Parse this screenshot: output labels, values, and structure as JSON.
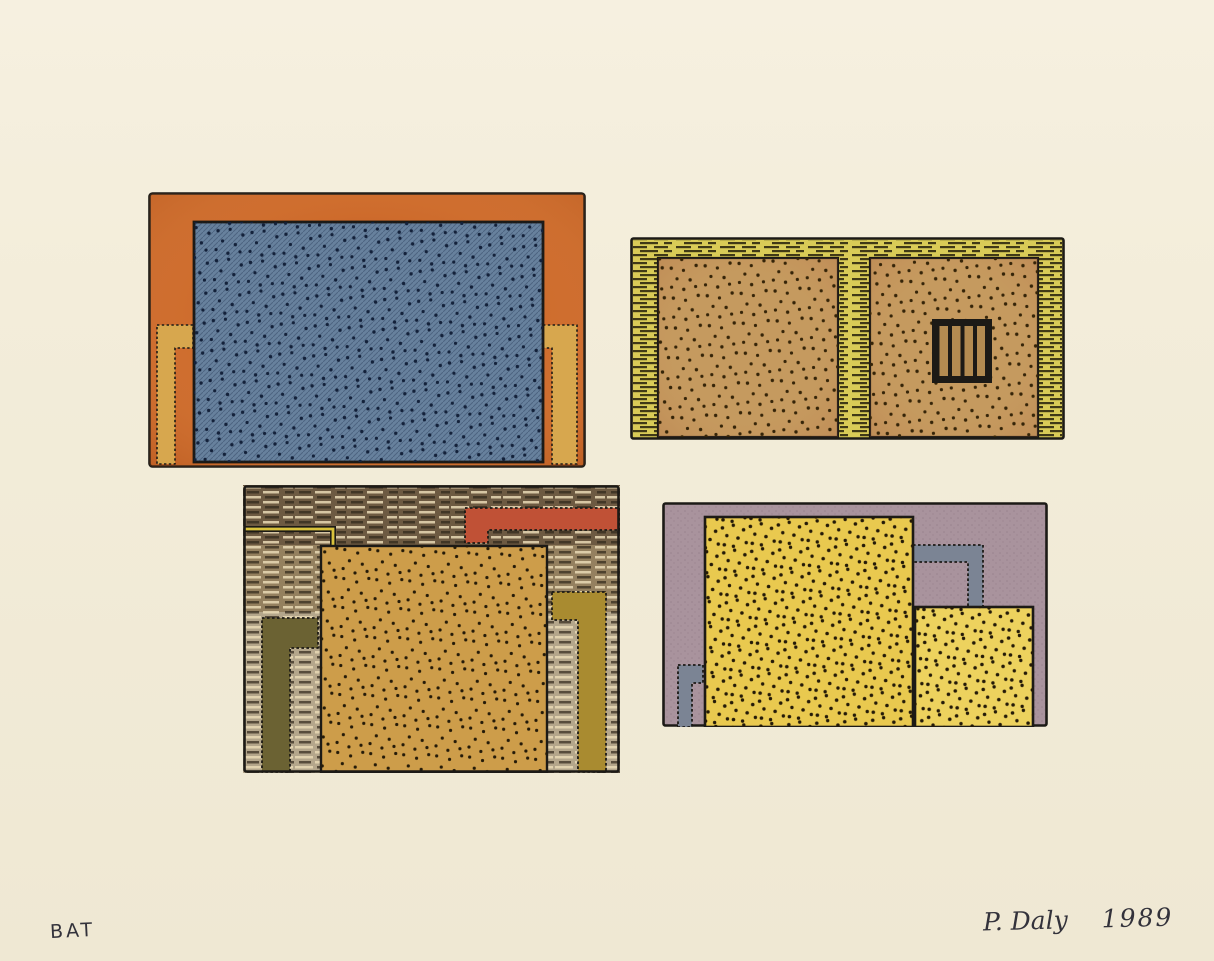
{
  "inscriptions": {
    "proof": "BAT",
    "artist": "P. Daly",
    "year": "1989"
  },
  "panels": [
    {
      "id": "top-left",
      "label": "orange-frame-with-blue-dotted-field"
    },
    {
      "id": "top-right",
      "label": "yellow-frame-two-tan-squares-barred-window"
    },
    {
      "id": "bottom-left",
      "label": "striped-wall-ochre-square-red-bar"
    },
    {
      "id": "bottom-right",
      "label": "mauve-field-two-yellow-dotted-squares"
    }
  ],
  "palette": {
    "paper": "#f3edda",
    "paperHi": "#f6f0e0",
    "paperLo": "#efe8d3",
    "ink": "#1c1a16",
    "pencil": "#33323b",
    "tlOrange": "#cd6a2b",
    "tlOrangeDeep": "#a84e18",
    "tlGold": "#d7a74e",
    "tlBlue": "#67819d",
    "dotNavy": "#13213a",
    "trYellow": "#d9cb57",
    "trTan": "#c59a5f",
    "windowSlat": "#b38b51",
    "dotBrown": "#352408",
    "blDark": "#6d5a42",
    "blMid": "#94805f",
    "blLight": "#b4a68b",
    "stripeCream": "#e9dab5",
    "stripeDark": "#2f2619",
    "blLineYellow": "#d9c23c",
    "blRed": "#c05136",
    "blOchre": "#cd9d4a",
    "blOlive": "#6b6233",
    "blGold": "#a98b30",
    "dotBlack": "#241a08",
    "brMauve": "#a9939d",
    "brGray": "#7b8494",
    "brYellow": "#e9c94f",
    "brYellowSm": "#edd25e"
  }
}
